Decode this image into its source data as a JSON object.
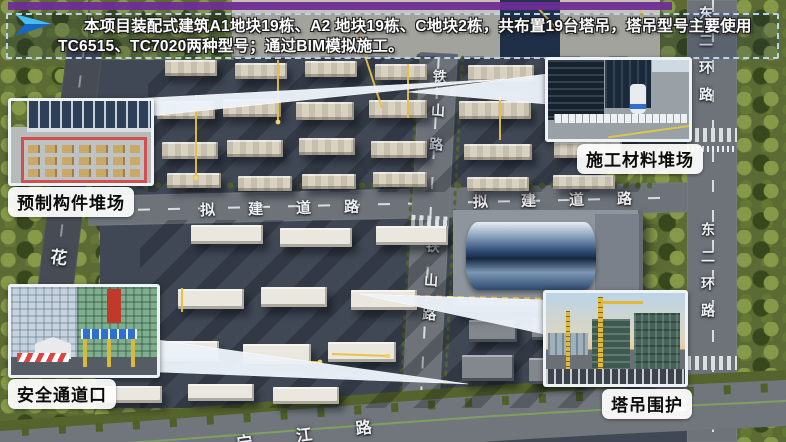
{
  "banner": {
    "line1": "本项目装配式建筑A1地块19栋、A2 地块19栋、C地块2栋，共布置19台塔吊，塔吊型号主要使用",
    "line2": "TC6515、TC7020两种型号；通过BIM模拟施工。",
    "accent_bar_color": "#6e2d96",
    "border_color": "#b9d2ef",
    "arrow_icon": "blue-paper-plane-arrow"
  },
  "callouts": {
    "precast": {
      "label": "预制构件堆场",
      "image": "precast-component-storage-yard-photo"
    },
    "materials": {
      "label": "施工材料堆场",
      "image": "construction-material-storage-yard-photo"
    },
    "safety": {
      "label": "安全通道口",
      "image": "safety-passage-entrance-photo"
    },
    "tower_crane": {
      "label": "塔吊围护",
      "image": "tower-crane-enclosure-photo"
    }
  },
  "roads": {
    "proposed_road": "拟建道路",
    "tieshan_road": "铁山路",
    "dongerhuan_road": "东二环路",
    "ningjiang_road": "宁江路",
    "hua_road": "花"
  },
  "colors": {
    "crane_marker": "#e7bf45",
    "callout_wedge": "#edf3fa",
    "ground": "#3f4854",
    "road": "#6e737a",
    "trees": "#5c6b33"
  }
}
